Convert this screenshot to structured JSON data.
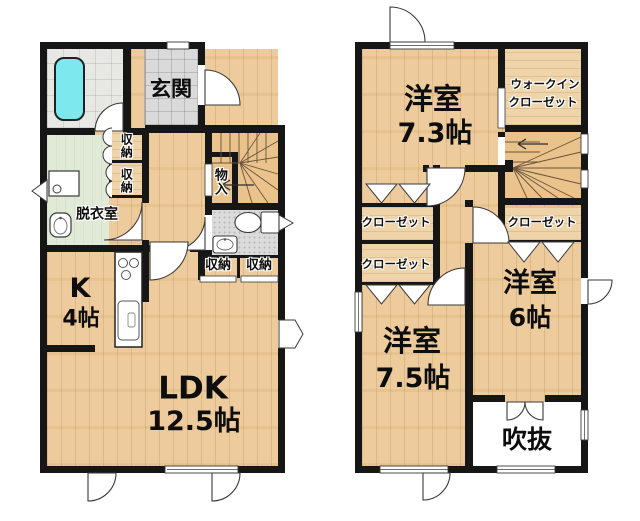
{
  "colors": {
    "wall": "#161616",
    "wood_floor": "#edcb9c",
    "stairs_floor": "#e9c28c",
    "entrance_tile": "#dadada",
    "bath_floor": "#e7e7e4",
    "dressing_floor": "#e1ead6",
    "toilet_floor": "#dbdbdb",
    "bathtub": "#7de9ef",
    "void_floor": "#ffffff"
  },
  "floor1": {
    "entrance": "玄関",
    "storage_1": "収納",
    "storage_2": "収納",
    "storage_3": "収納",
    "storage_4": "収納",
    "dressing_room": "脱衣室",
    "hall_closet": "物入",
    "kitchen": "K",
    "kitchen_size": "4帖",
    "ldk": "LDK",
    "ldk_size": "12.5帖"
  },
  "floor2": {
    "bedroom_a": "洋室",
    "bedroom_a_size": "7.3帖",
    "wic_line1": "ウォークイン",
    "wic_line2": "クローゼット",
    "closet_a": "クローゼット",
    "closet_b": "クローゼット",
    "closet_c": "クローゼット",
    "bedroom_b": "洋室",
    "bedroom_b_size": "6帖",
    "bedroom_c": "洋室",
    "bedroom_c_size": "7.5帖",
    "void": "吹抜"
  }
}
